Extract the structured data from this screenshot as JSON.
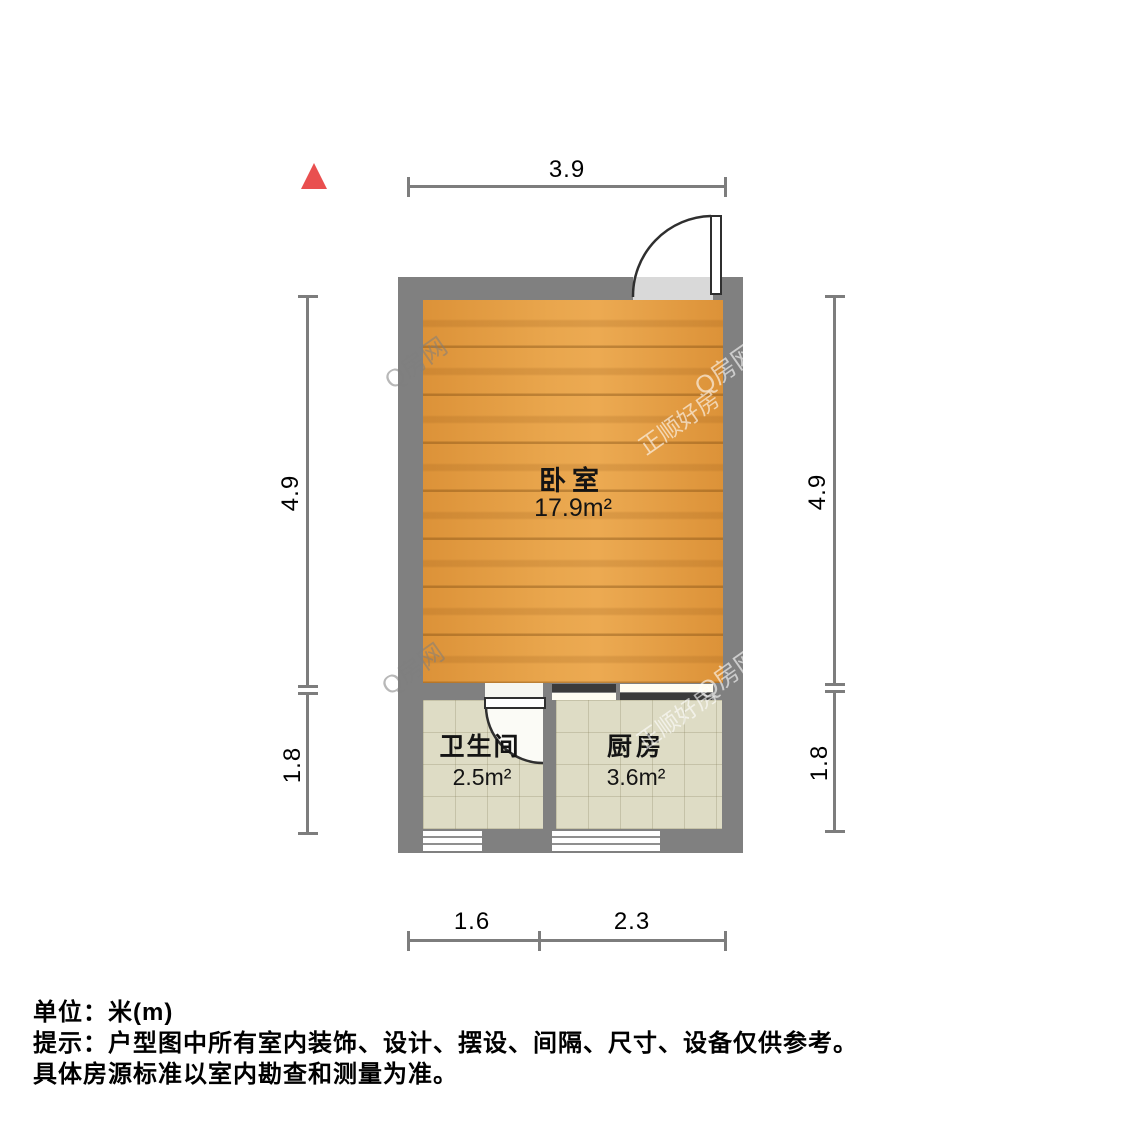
{
  "plan": {
    "type": "apartment-floor-plan",
    "north_indicator": "north-arrow",
    "rooms": [
      {
        "name": "卧室",
        "area": "17.9m²",
        "floor": "wood"
      },
      {
        "name": "卫生间",
        "area": "2.5m²",
        "floor": "tile"
      },
      {
        "name": "厨房",
        "area": "3.6m²",
        "floor": "tile"
      }
    ],
    "dimensions": {
      "top": "3.9",
      "left_upper": "4.9",
      "left_lower": "1.8",
      "right_upper": "4.9",
      "right_lower": "1.8",
      "bottom_left": "1.6",
      "bottom_right": "2.3"
    }
  },
  "watermarks": [
    {
      "text": "Q房网"
    },
    {
      "text": "Q房网"
    },
    {
      "text": "正顺好房"
    },
    {
      "text": "Q房网"
    },
    {
      "text": "Q房网"
    },
    {
      "text": "正顺好房"
    }
  ],
  "footer": {
    "line1": "单位：米(m)",
    "line2": "提示：户型图中所有室内装饰、设计、摆设、间隔、尺寸、设备仅供参考。",
    "line3": "具体房源标准以室内勘查和测量为准。"
  },
  "colors": {
    "wall": "#808080",
    "wood_floor": "#e29b43",
    "tile_floor": "#dedcc5",
    "north_arrow": "#e94f4f",
    "dimension_line": "#7d7d7d",
    "sliding_door_dark": "#3b3b3b"
  }
}
